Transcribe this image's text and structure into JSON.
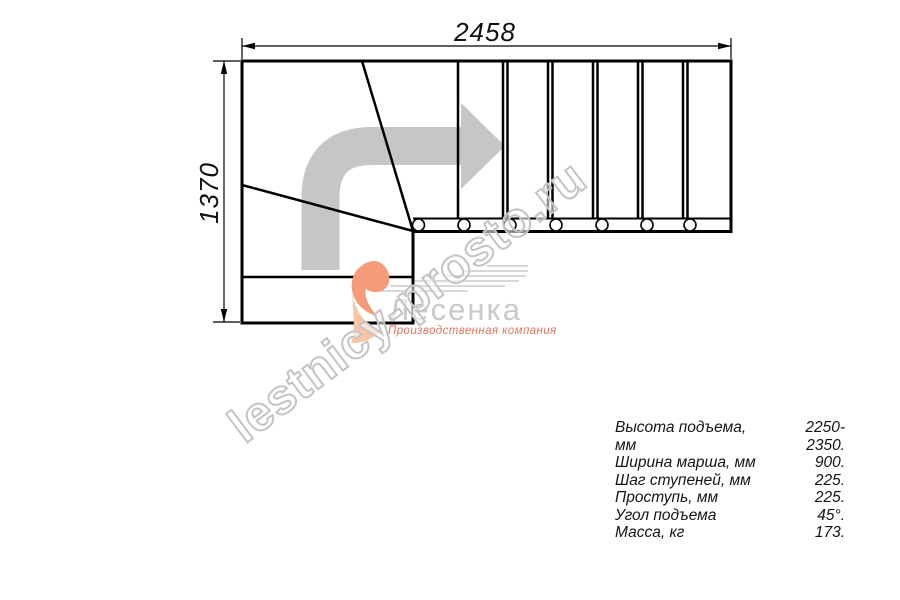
{
  "drawing": {
    "width_label": "2458",
    "height_label": "1370",
    "line_color": "#000000",
    "arrow_color": "#c6c6c6",
    "type": "staircase-floor-plan",
    "tread_count_straight": 6,
    "winder_count": 3,
    "baluster_marker_count": 7
  },
  "watermark": {
    "text": "lestnicy-prosto.ru",
    "color": "#c4c4c4"
  },
  "logo": {
    "name": "Лесенка",
    "tagline": "Производственная компания",
    "swoosh_color": "#f59b77",
    "swoosh_color_light": "#f9c4a4",
    "name_color": "#c9c9c9",
    "tagline_color": "#e4745c"
  },
  "specs": {
    "rows": [
      {
        "label": "Высота подъема, мм",
        "value": "2250-2350."
      },
      {
        "label": "Ширина марша, мм",
        "value": "900."
      },
      {
        "label": "Шаг ступеней, мм",
        "value": "225."
      },
      {
        "label": "Проступь, мм",
        "value": "225."
      },
      {
        "label": "Угол подъема",
        "value": "45°."
      },
      {
        "label": "Масса, кг",
        "value": "173."
      }
    ]
  }
}
